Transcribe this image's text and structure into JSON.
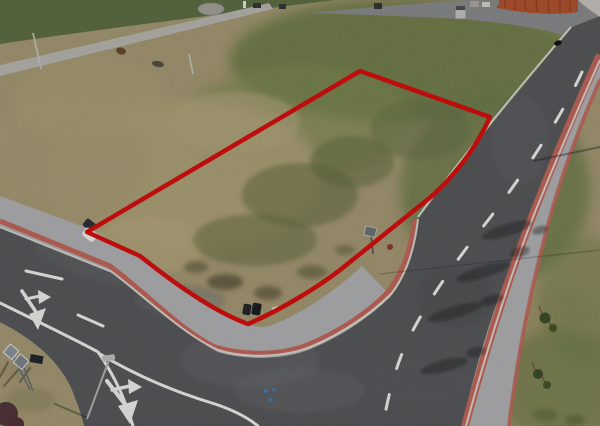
{
  "scene": {
    "title": "Aerial drone photograph of an empty building plot for sale, its boundary marked with a red outline, beside a new residential street junction",
    "type": "aerial-photograph",
    "visible_text": "none"
  },
  "palette": {
    "grass_dry": "#a89b76",
    "grass_green": "#6f7f4b",
    "grass_dark_band": "#5f7046",
    "asphalt": "#595a5d",
    "top_road": "#8c8d8f",
    "paver_gray": "#b4b5b7",
    "paver_red_stripe": "#c4685c",
    "curb_white": "#e3e3e0",
    "road_marking": "#f1f2ee",
    "plot_outline_red": "#d9100f",
    "roof_orange": "#b35531",
    "shadow": "rgba(22,26,34,0.38)"
  },
  "annotation": {
    "plot_outline": {
      "color": "#d9100f",
      "stroke_width": 4.5,
      "shape": "quadrilateral plot with rounded lower corner following sidewalk",
      "path": "M87,232 L360,71 L490,117 C477,146 458,172 432,196 C402,220 372,244 340,270 C314,290 278,311 248,324 C212,311 170,280 140,256 Z"
    }
  },
  "geometry": {
    "green_band": "M0,0 L335,0 C240,12 120,26 0,44 Z",
    "footpath": "M0,65 L269,3 L273,9 L0,76 Z",
    "top_road": "M310,13 C380,6 440,2 468,0 L600,0 L600,46 C560,30 500,22 460,19 C400,16 345,14 310,13 Z",
    "asphalt": "M572,27 C520,90 468,152 418,218 C414,247 407,275 391,296 C372,315 343,336 308,350 C285,359 248,361 218,352 C185,335 150,300 112,271 L0,226 L0,322 C35,340 60,362 72,390 C79,408 82,416 84,426 L462,426 C478,355 500,285 533,213 C555,155 580,105 600,58 L600,16 Z",
    "sidewalk_north": "M0,196 L95,231 C150,263 195,297 238,320 C252,327 262,329 272,325 C305,312 336,290 362,266 L391,296 C372,315 343,336 308,350 C285,359 248,361 218,352 C185,335 150,300 112,271 L0,226 Z",
    "sidewalk_east": "M600,76 C582,120 562,172 545,235 C530,292 516,360 508,426 L462,426 C478,355 500,285 533,213 C556,152 580,104 600,56 Z",
    "stripe_north": "M0,221 L110,266 C150,296 180,330 215,347 C245,356 280,355 305,346 C340,332 370,311 388,292 C404,272 412,244 415,220",
    "stripe_east_inner": "M600,55 C578,103 556,155 534,212 C511,270 487,345 465,426",
    "stripe_east_outer": "M600,80 C580,125 561,175 546,232 C531,290 517,358 509,426",
    "curb_north": "M0,227 L112,272 C150,301 183,334 218,350 C247,359 284,357 310,347 C344,333 373,312 392,293 C407,273 415,246 418,219",
    "curb_west_upper": "M418,217 C460,160 515,92 571,27",
    "curb_east": "M600,60 C578,108 557,158 535,212 C512,271 488,345 466,426",
    "mark_center_dash": "M582,72 C560,120 520,180 482,228 C452,266 425,305 408,340 C396,365 388,395 383,426",
    "mark_branch_dashes": "M26,271 L62,279 M78,315 L103,326",
    "mark_edge_sw": "M0,303 C45,325 80,342 98,352 C112,372 125,398 133,426",
    "mark_channel": "M100,354 C135,375 175,392 215,404 C233,410 247,417 258,426",
    "arrow_a_shaft": "M22,291 L36,312",
    "arrow_a_head": "M29,314 L46,308 L38,330 Z",
    "arrow_a_branch": "M26,299 L40,296",
    "arrow_a_branch_head": "M38,290 L51,297 L39,304 Z",
    "arrow_b_shaft": "M107,381 L127,407",
    "arrow_b_head": "M118,406 L138,400 L130,424 Z",
    "arrow_b_branch": "M112,390 L130,386",
    "arrow_b_branch_head": "M128,379 L142,387 L129,394 Z",
    "shadow_wire": "M380,274 L600,250",
    "shadow_lamp_tr": "M600,147 L534,161",
    "shadow_signs": "M8,362 L0,377 M18,370 L4,386 M30,368 L20,382",
    "shadow_lamp_bl": "M88,418 L55,404",
    "roof": "M497,0 L578,0 L578,12 C552,16 523,13 497,8 Z",
    "roof_ridges": "M505,1 L505,8 M515,1 L515,10 M525,1 L526,11 M536,0 L537,12 M548,0 L549,13 M560,0 L560,13 M570,0 L570,12",
    "driveway": "M578,0 L600,0 L600,17 C591,11 584,6 578,0 Z",
    "tree_trunks": "M543,316 L539,306 M551,326 L547,316 M536,372 L532,362 M545,383 L541,373",
    "sign_mid_pole": "M371,236 L373,254",
    "signs_bl_poles": "M14,358 L30,390 M24,368 L33,391",
    "lamp_field_1": "M33,33 L41,69",
    "lamp_field_2": "M189,54 L193,74",
    "lamp_bl_pole": "M109,360 L87,419"
  },
  "objects": {
    "parked_vehicle": "small white vehicle with dark windshield on inner sidewalk at plot corner",
    "waste_bins": "two dark bins on sidewalk near inner curve",
    "road_signs_bottom_left": "two gray sign backs on poles with shadows",
    "street_lamp_bottom": "lamp arm over side road",
    "hydrant": "small red-brown hydrant on verge",
    "young_trees": "staked saplings along right sidewalk casting long shadows",
    "building_roof": "orange tiled roof at top right",
    "utility_boxes": "small gray boxes along top edge",
    "bird": "dark bird on grass near top right",
    "blue_paint_dots": "three blue survey paint dots on junction asphalt"
  }
}
